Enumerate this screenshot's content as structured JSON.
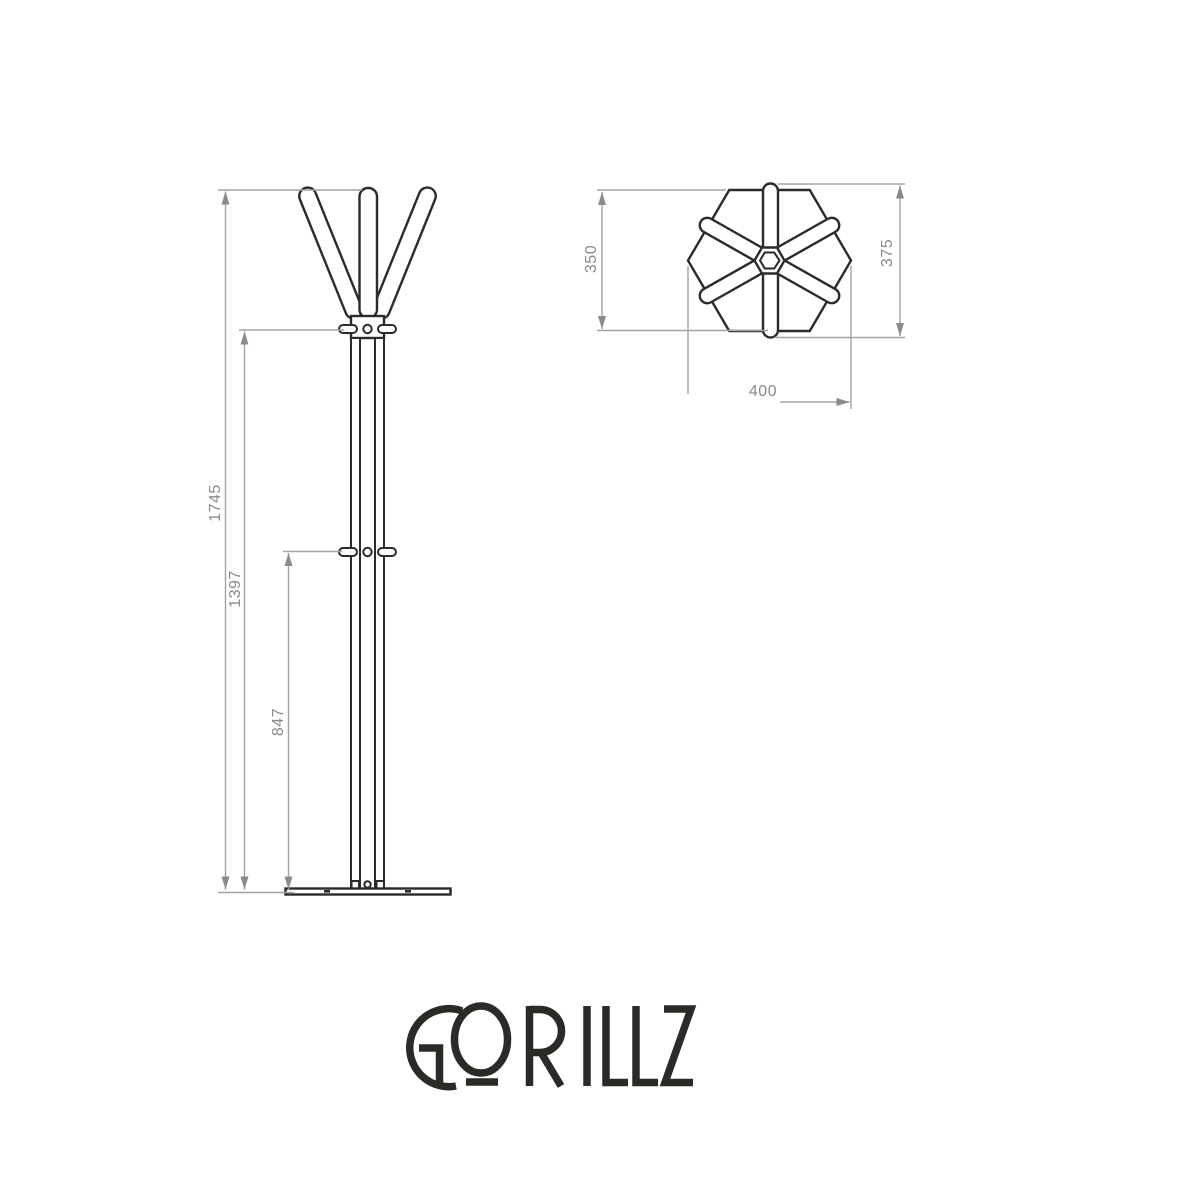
{
  "drawing": {
    "front_view": {
      "dimensions": {
        "overall_height": "1745",
        "upper_hook_height": "1397",
        "mid_hook_height": "847"
      }
    },
    "top_view": {
      "dimensions": {
        "body_width": "350",
        "overall_depth": "375",
        "overall_width": "400"
      }
    }
  },
  "logo": {
    "text": "GORILLZ"
  },
  "colors": {
    "background": "#ffffff",
    "object_outline": "#2b2b2b",
    "dimension_line": "#a3a3a3",
    "dimension_text": "#8a8a8a",
    "logo_ink": "#2b2a26"
  }
}
